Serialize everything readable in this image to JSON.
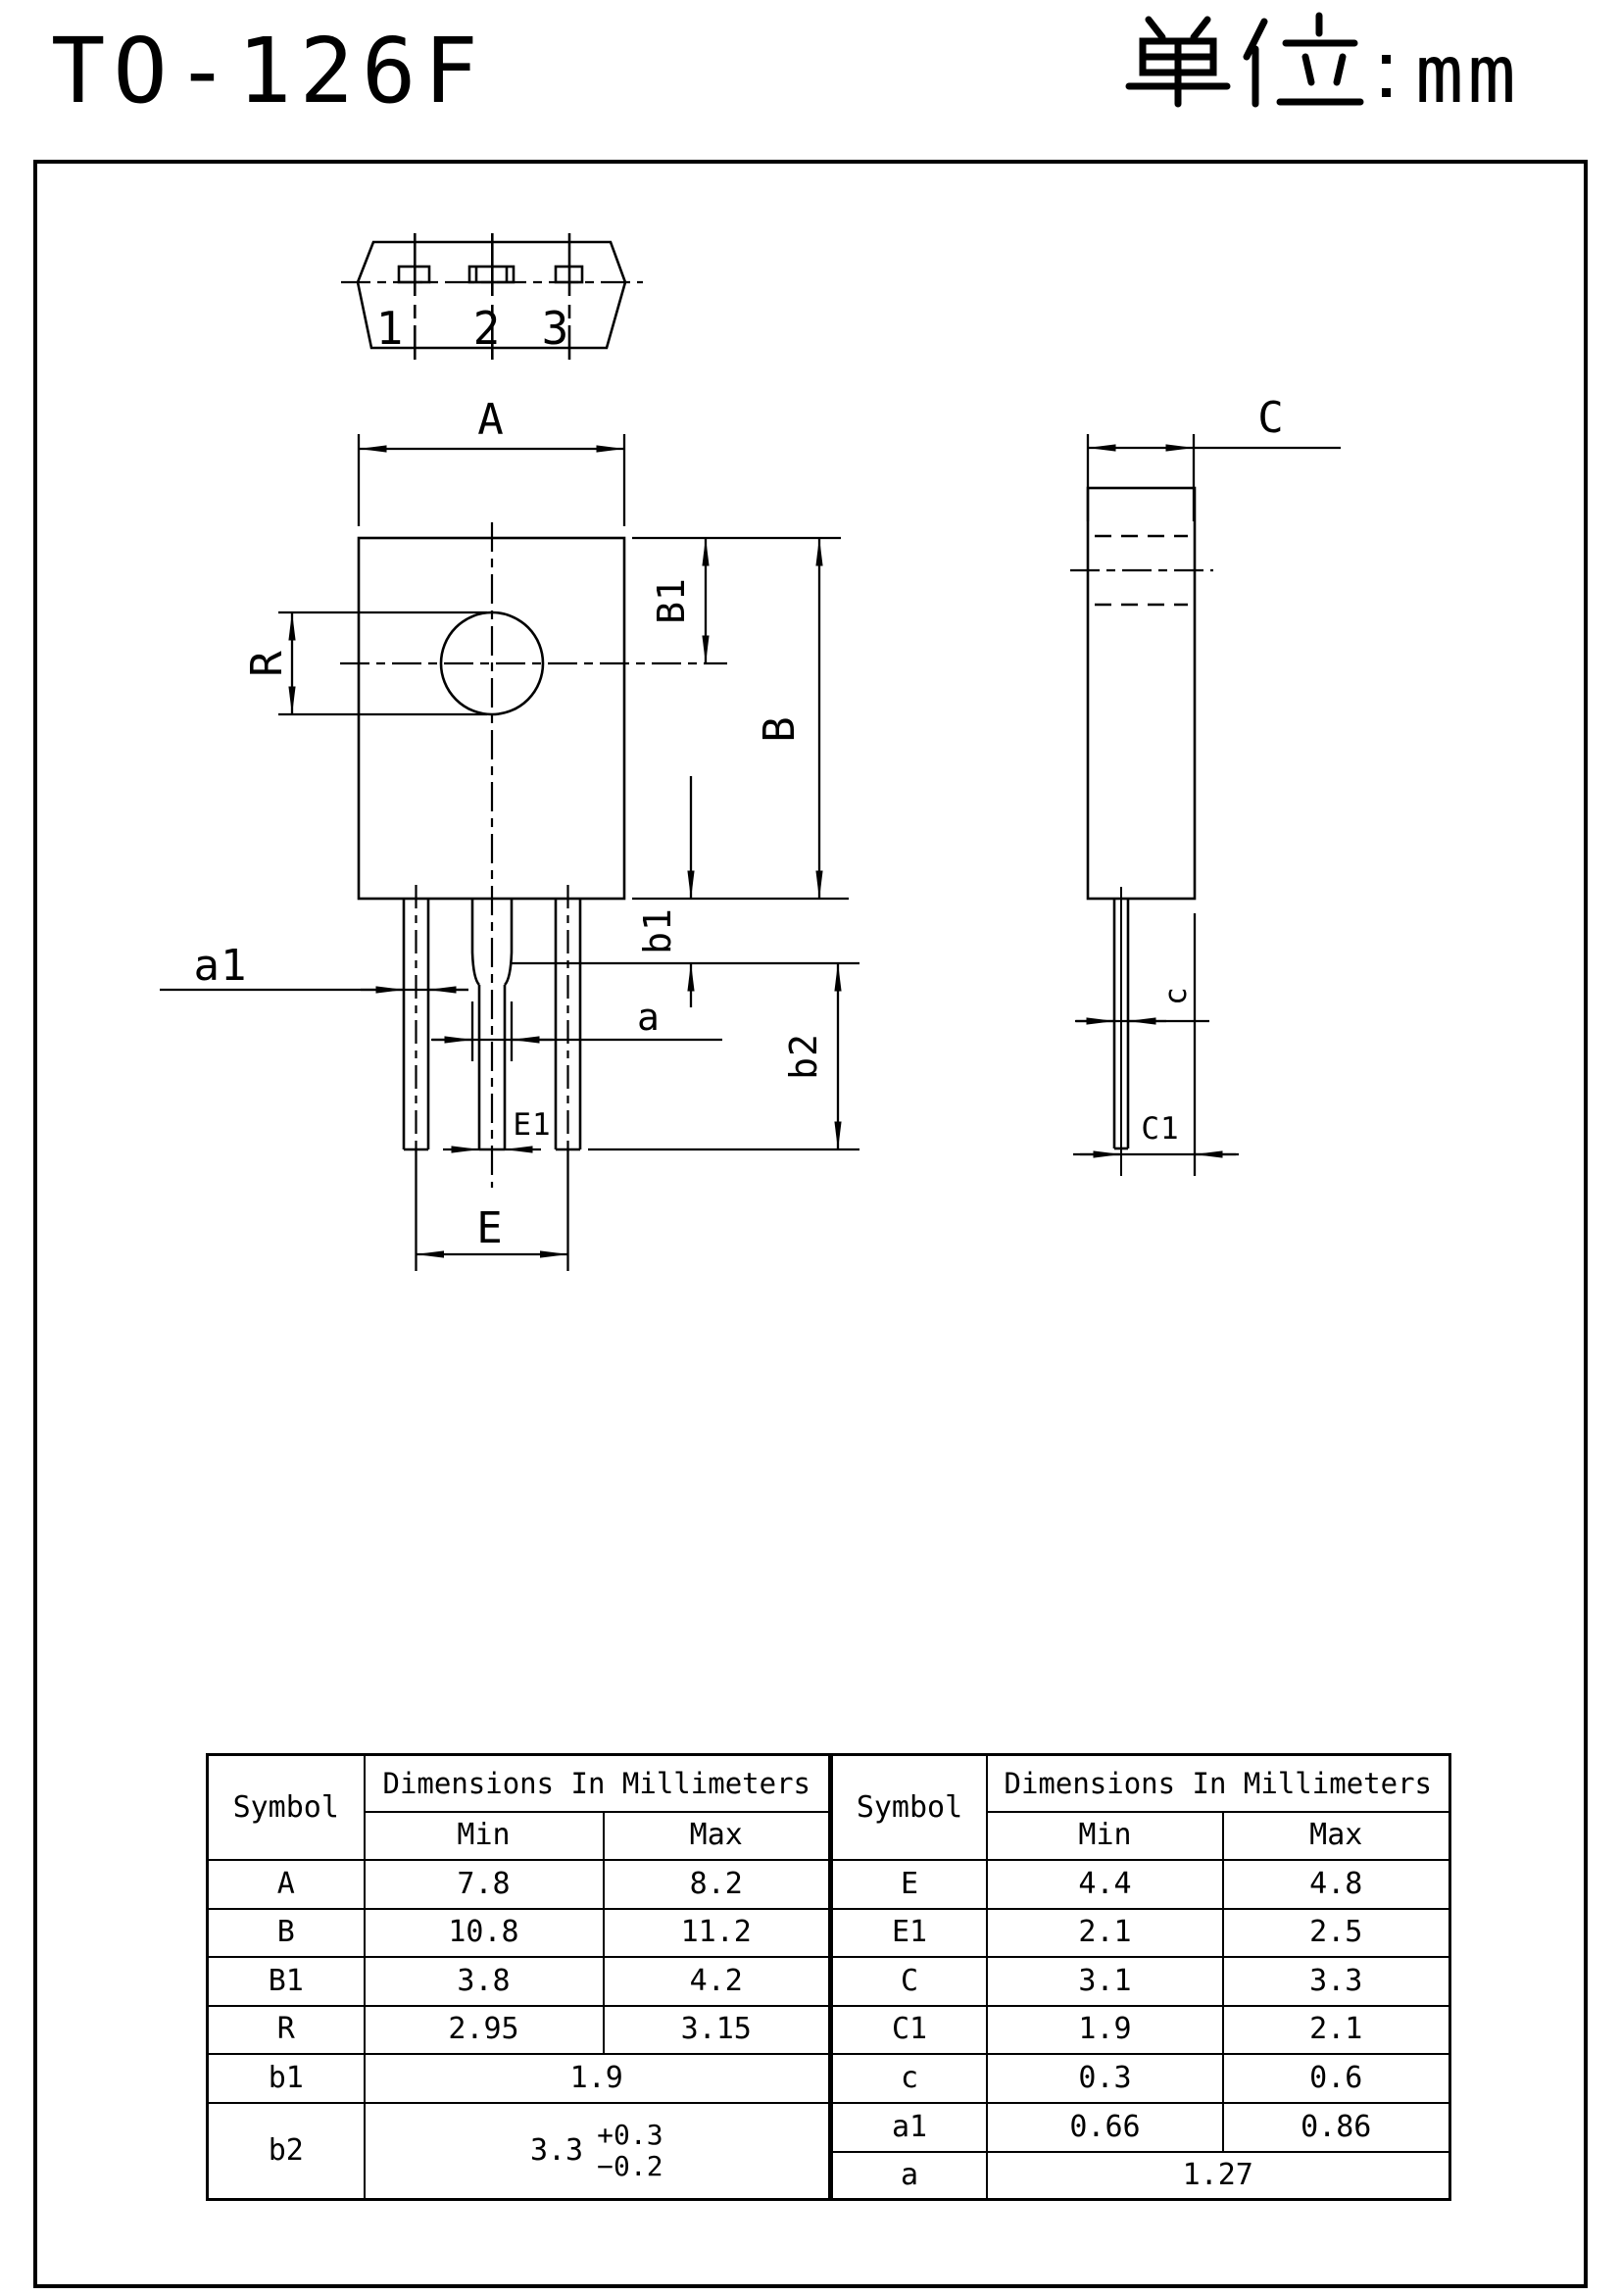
{
  "header": {
    "title": "TO-126F",
    "unit_cjk": "单位",
    "unit_colon": "：",
    "unit_suffix": "mm",
    "unit_full": "单位：mm"
  },
  "views": {
    "top": {
      "pins": {
        "p1": "1",
        "p2": "2",
        "p3": "3"
      }
    },
    "front": {
      "dims": {
        "A": "A",
        "B": "B",
        "B1": "B1",
        "R": "R",
        "a1": "a1",
        "a": "a",
        "b1": "b1",
        "b2": "b2",
        "E1": "E1",
        "E": "E"
      }
    },
    "side": {
      "dims": {
        "C": "C",
        "c": "c",
        "C1": "C1"
      }
    }
  },
  "table": {
    "left": {
      "headers": {
        "symbol": "Symbol",
        "group": "Dimensions In Millimeters",
        "min": "Min",
        "max": "Max"
      },
      "rows": [
        {
          "symbol": "A",
          "min": "7.8",
          "max": "8.2"
        },
        {
          "symbol": "B",
          "min": "10.8",
          "max": "11.2"
        },
        {
          "symbol": "B1",
          "min": "3.8",
          "max": "4.2"
        },
        {
          "symbol": "R",
          "min": "2.95",
          "max": "3.15"
        },
        {
          "symbol": "b1",
          "value": "1.9"
        },
        {
          "symbol": "b2",
          "value": "3.3",
          "tol_plus": "+0.3",
          "tol_minus": "−0.2"
        }
      ]
    },
    "right": {
      "headers": {
        "symbol": "Symbol",
        "group": "Dimensions In Millimeters",
        "min": "Min",
        "max": "Max"
      },
      "rows": [
        {
          "symbol": "E",
          "min": "4.4",
          "max": "4.8"
        },
        {
          "symbol": "E1",
          "min": "2.1",
          "max": "2.5"
        },
        {
          "symbol": "C",
          "min": "3.1",
          "max": "3.3"
        },
        {
          "symbol": "C1",
          "min": "1.9",
          "max": "2.1"
        },
        {
          "symbol": "c",
          "min": "0.3",
          "max": "0.6"
        },
        {
          "symbol": "a1",
          "min": "0.66",
          "max": "0.86"
        },
        {
          "symbol": "a",
          "value": "1.27"
        }
      ]
    }
  }
}
